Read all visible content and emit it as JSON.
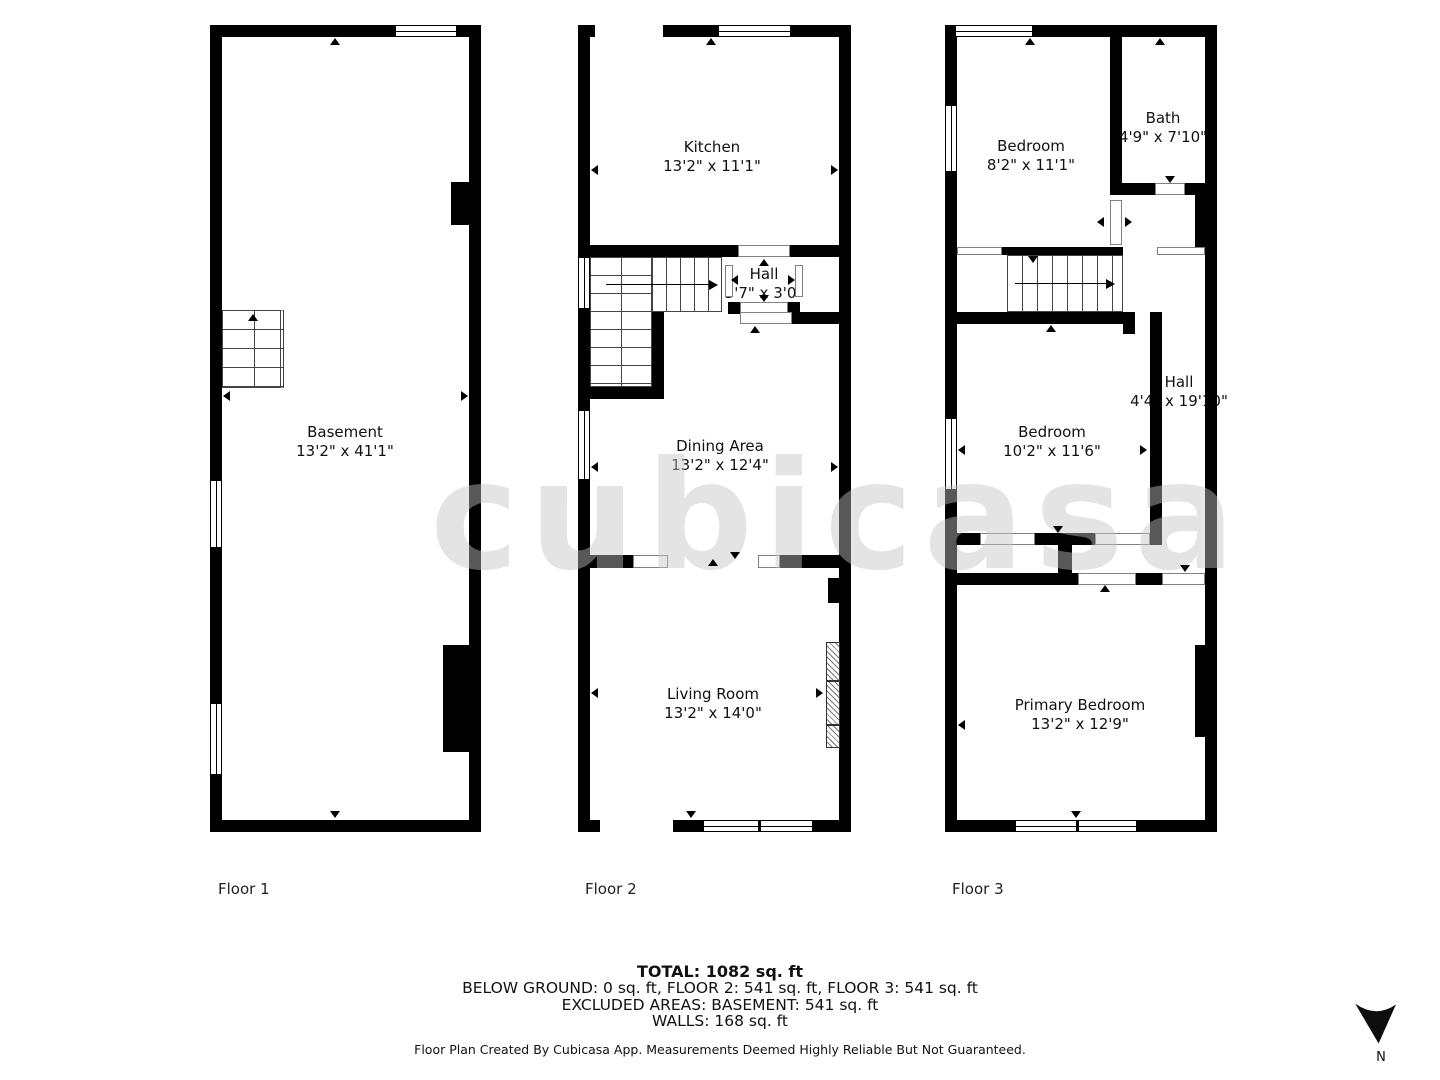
{
  "floors": [
    {
      "label": "Floor 1",
      "rooms": [
        {
          "name": "Basement",
          "dims": "13'2\" x 41'1\""
        }
      ]
    },
    {
      "label": "Floor 2",
      "rooms": [
        {
          "name": "Kitchen",
          "dims": "13'2\" x 11'1\""
        },
        {
          "name": "Hall",
          "dims": "3'7\" x 3'0\""
        },
        {
          "name": "Dining Area",
          "dims": "13'2\" x 12'4\""
        },
        {
          "name": "Living Room",
          "dims": "13'2\" x 14'0\""
        }
      ]
    },
    {
      "label": "Floor 3",
      "rooms": [
        {
          "name": "Bedroom",
          "dims": "8'2\" x 11'1\""
        },
        {
          "name": "Bath",
          "dims": "4'9\" x 7'10\""
        },
        {
          "name": "Bedroom",
          "dims": "10'2\" x 11'6\""
        },
        {
          "name": "Hall",
          "dims": "4'4\" x 19'10\""
        },
        {
          "name": "Primary Bedroom",
          "dims": "13'2\" x 12'9\""
        }
      ]
    }
  ],
  "summary": {
    "total": "TOTAL: 1082 sq. ft",
    "below_ground": "BELOW GROUND: 0 sq. ft, FLOOR 2: 541 sq. ft, FLOOR 3: 541 sq. ft",
    "excluded": "EXCLUDED AREAS: BASEMENT: 541 sq. ft",
    "walls": "WALLS: 168 sq. ft"
  },
  "footer": "Floor Plan Created By Cubicasa App. Measurements Deemed Highly Reliable But Not Guaranteed.",
  "compass": {
    "label": "N"
  },
  "watermark": "cubicasa",
  "colors": {
    "wall": "#000000",
    "background": "#ffffff"
  }
}
